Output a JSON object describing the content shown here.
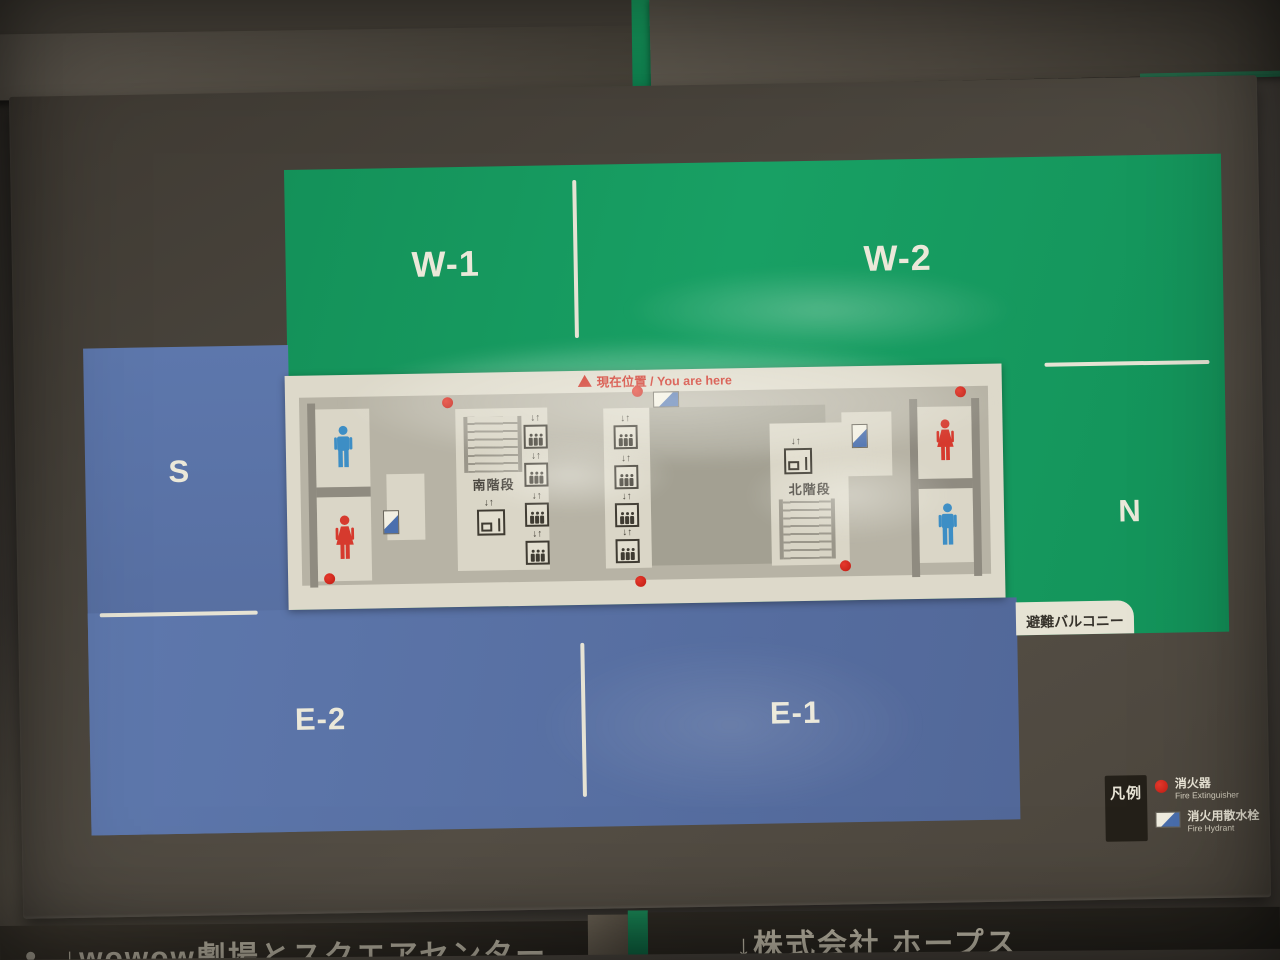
{
  "map": {
    "you_are_here": "現在位置 / You are here",
    "zones": {
      "w1": "W-1",
      "w2": "W-2",
      "n": "N",
      "s": "S",
      "e2": "E-2",
      "e1": "E-1"
    },
    "stairs_south": "南階段",
    "stairs_north": "北階段",
    "balcony": "避難バルコニー",
    "elevator_arrows": "↓↑",
    "legend": {
      "title": "凡例",
      "extinguisher_jp": "消火器",
      "extinguisher_en": "Fire Extinguisher",
      "hydrant_jp": "消火用散水栓",
      "hydrant_en": "Fire Hydrant"
    },
    "colors": {
      "zone_green": "#169a61",
      "zone_blue": "#5b74a9",
      "marker_red": "#d6281e",
      "hydrant_blue": "#4a6fae",
      "plan_cream": "#ddd9ca"
    }
  },
  "bottom_signs": {
    "left": "↓wowow劇場とスクエアセンター",
    "right": "↓株式会社 ホープス"
  }
}
